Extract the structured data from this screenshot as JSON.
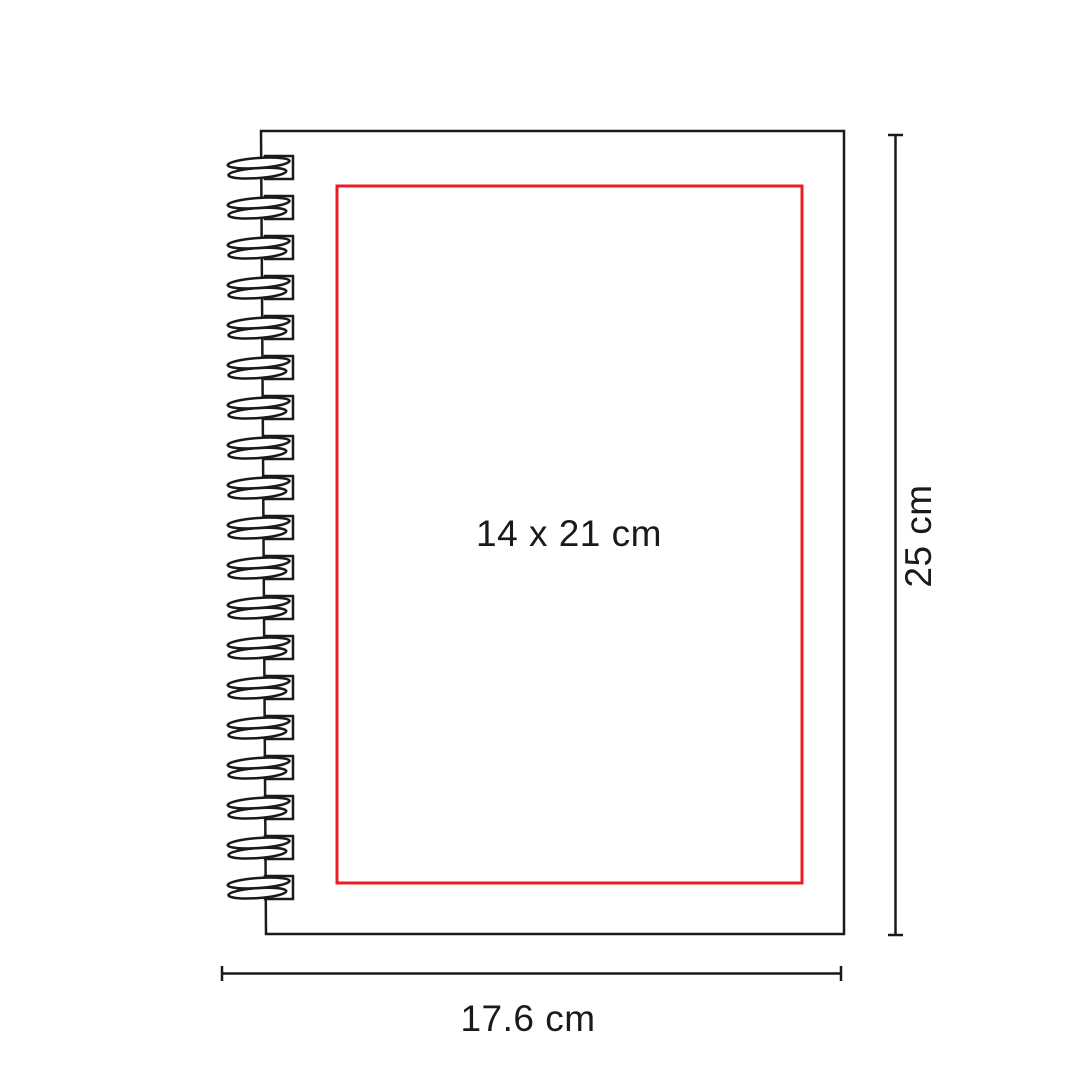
{
  "diagram": {
    "background_color": "#ffffff",
    "line_color": "#1a1a1a",
    "accent_color": "#ed1c24",
    "print_area": {
      "label": "14 x 21 cm"
    },
    "dimensions": {
      "height_label": "25 cm",
      "width_label": "17.6 cm"
    }
  }
}
